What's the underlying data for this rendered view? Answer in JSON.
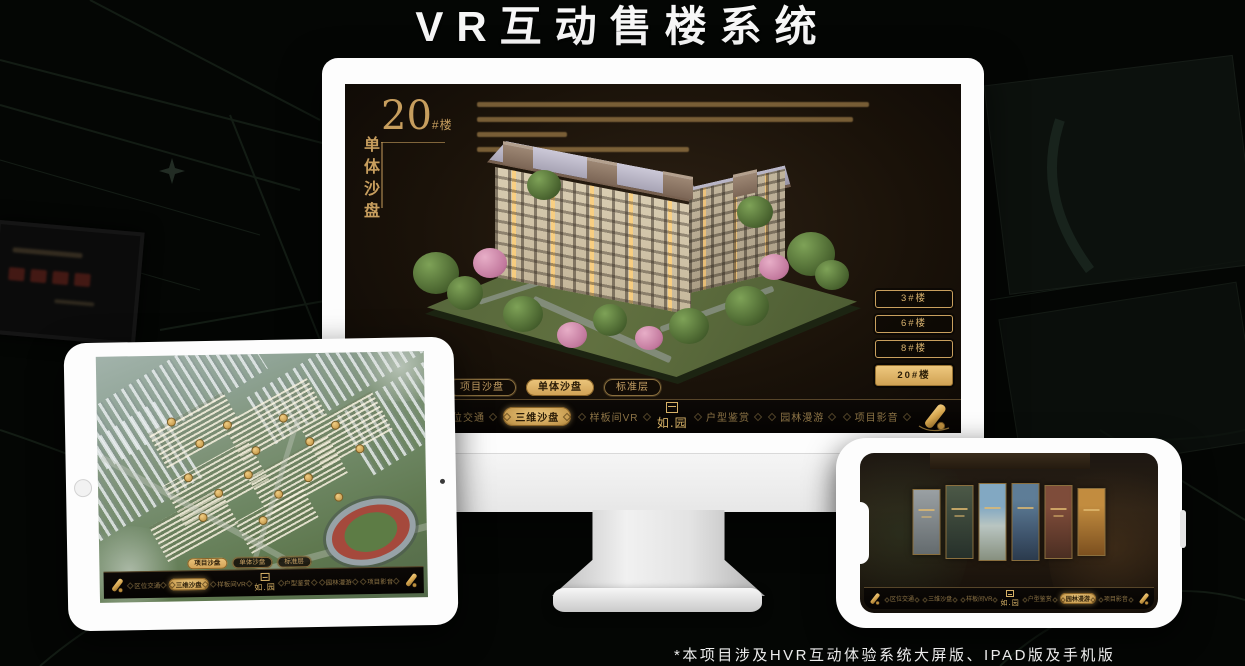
{
  "page": {
    "title": "VR互动售楼系统",
    "footnote": "*本项目涉及HVR互动体验系统大屏版、IPAD版及手机版"
  },
  "brand": {
    "logo_text": "如.园",
    "colors": {
      "gold": "#d2a965",
      "gold_bright": "#ecc87e",
      "screen_bg": "#1a1209",
      "device_white": "#fdfdfd"
    }
  },
  "nav": {
    "items": [
      {
        "label": "区位交通"
      },
      {
        "label": "三维沙盘"
      },
      {
        "label": "样板间VR"
      },
      {
        "label": "户型鉴赏"
      },
      {
        "label": "园林漫游"
      },
      {
        "label": "项目影音"
      }
    ]
  },
  "tabs": [
    {
      "label": "项目沙盘"
    },
    {
      "label": "单体沙盘"
    },
    {
      "label": "标准层"
    }
  ],
  "desktop_screen": {
    "building_number": "20",
    "building_number_suffix": "#楼",
    "building_subtitle": "单体沙盘",
    "active_tab": "单体沙盘",
    "active_nav": "三维沙盘",
    "floor_buttons": [
      {
        "label": "3#楼",
        "active": false
      },
      {
        "label": "6#楼",
        "active": false
      },
      {
        "label": "8#楼",
        "active": false
      },
      {
        "label": "20#楼",
        "active": true
      }
    ]
  },
  "tablet_screen": {
    "active_tab": "项目沙盘",
    "active_nav": "三维沙盘"
  },
  "phone_screen": {
    "active_nav": "园林漫游",
    "gallery_panel_count": 6
  }
}
